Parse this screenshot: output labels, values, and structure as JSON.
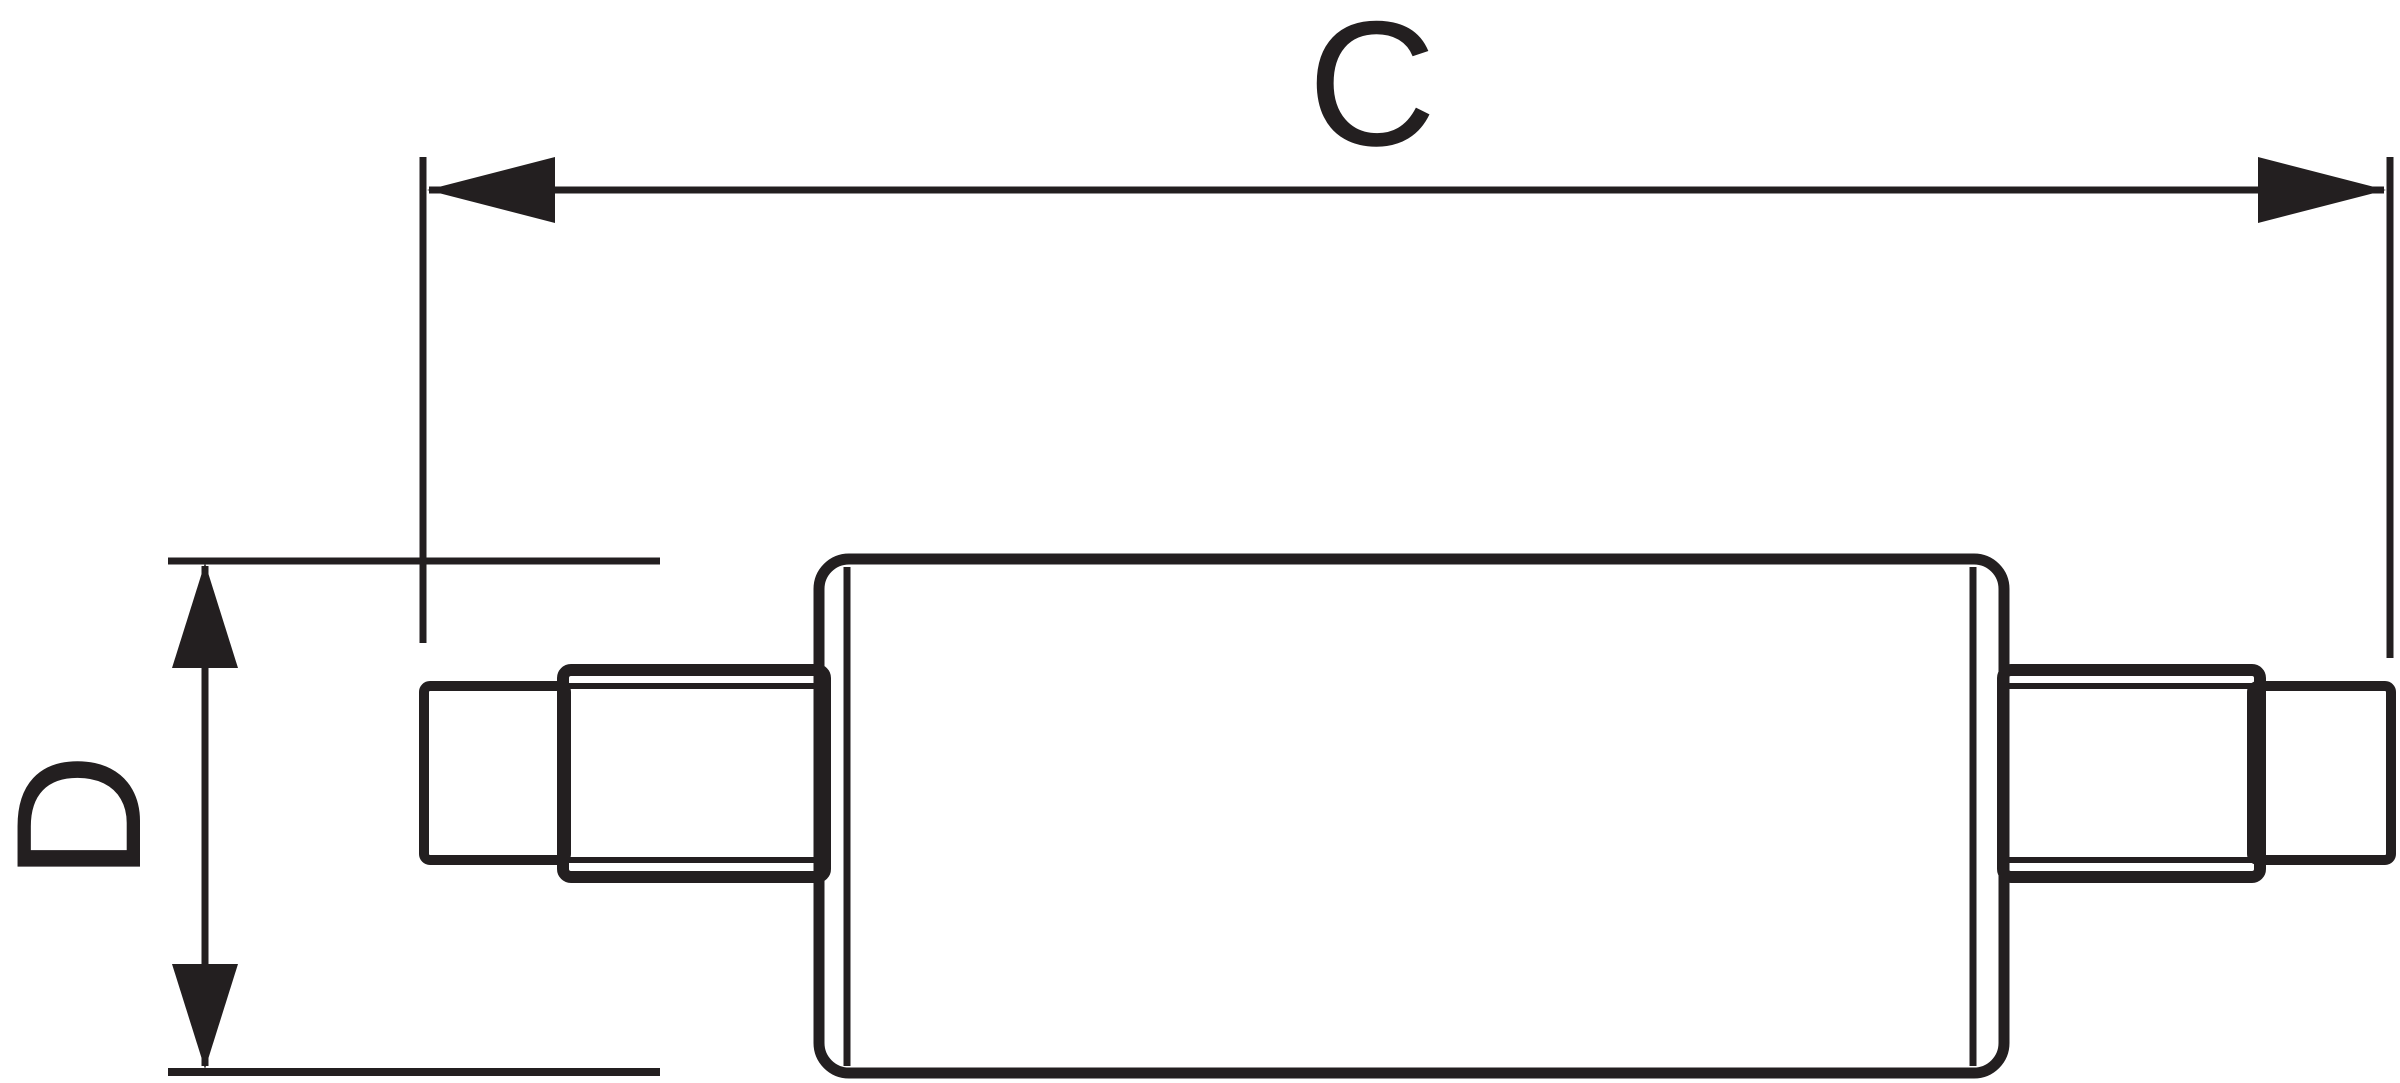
{
  "diagram": {
    "labels": {
      "length": "C",
      "diameter": "D"
    },
    "colors": {
      "ink": "#231f20",
      "background": "#ffffff"
    }
  }
}
